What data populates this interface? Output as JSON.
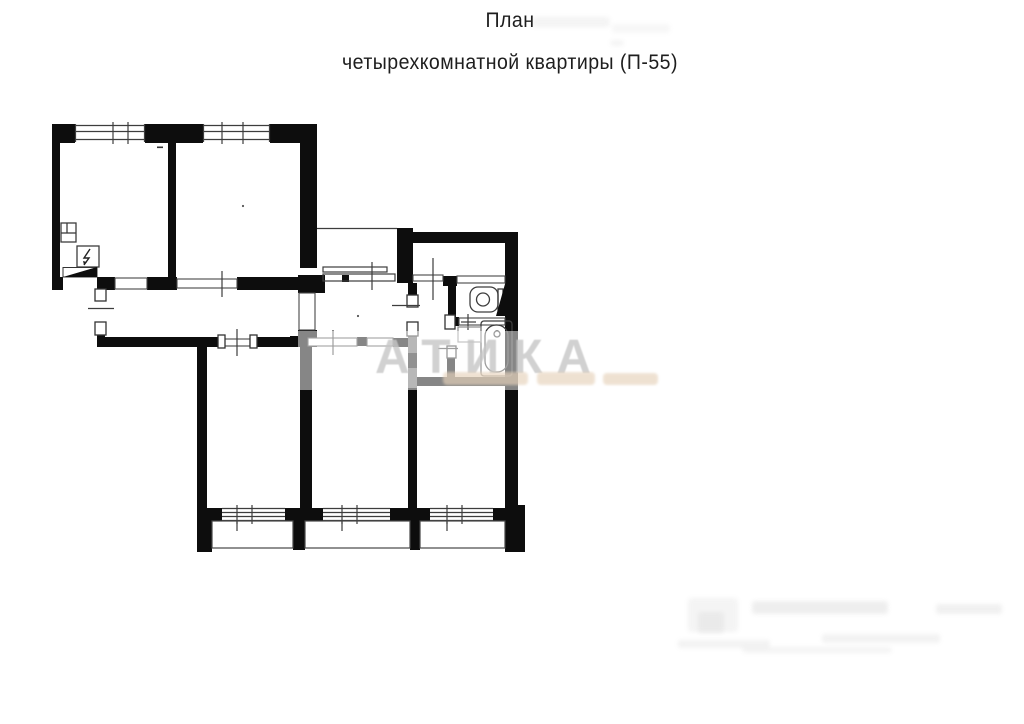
{
  "title": {
    "line1": "План",
    "line2": "четырехкомнатной квартиры (П-55)"
  },
  "watermark": {
    "text": "АТИКА"
  },
  "colors": {
    "wall": "#0d0d0d",
    "thin_line": "#3d3d3d",
    "faded_wall": "#6f6f6f",
    "watermark_gray": "#c6c6c6",
    "watermark_tan": "#e6d2ba",
    "background": "#ffffff",
    "title_text": "#1e1e1e"
  }
}
